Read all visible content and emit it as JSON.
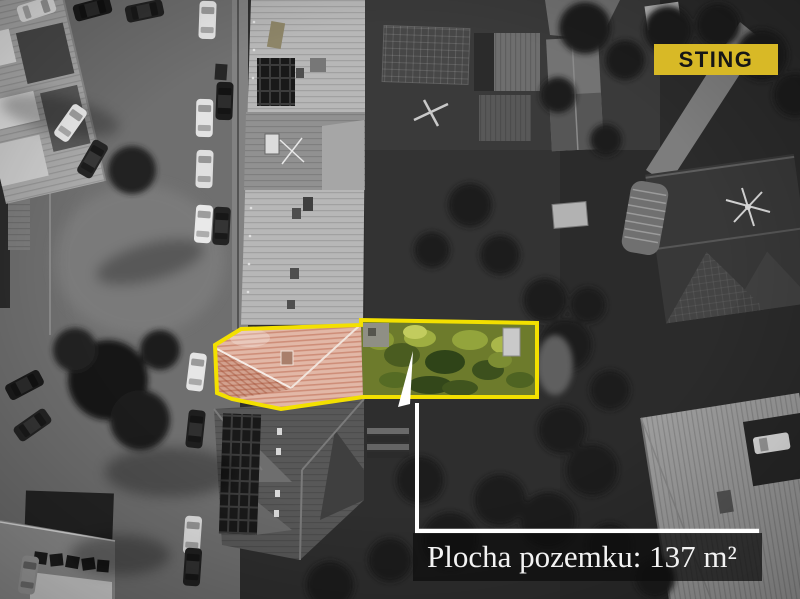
{
  "logo": {
    "text": "STING",
    "bg_color": "#d8b926",
    "text_color": "#161616"
  },
  "annotation": {
    "area_label": "Plocha pozemku: 137 m²",
    "line_color": "#ffffff",
    "box_bg": "rgba(13,13,13,0.72)",
    "text_color": "#f3f3f3"
  },
  "highlight": {
    "outline_color": "#f3e000",
    "outline_width": "4",
    "polygon_points": "215,345 241,329 361,325 361,320 537,323 537,397 363,397 281,409 232,399 217,393",
    "roof_points": "215,345 241,329 361,325 363,397 281,409 232,399 217,393",
    "garden_points": "361,325 361,320 537,323 537,397 363,397"
  },
  "scene_palette": {
    "street": "#6f6f6f",
    "garden_dark": "#2e2e2e",
    "building_roof": "#b7b7b7",
    "highlight_roof": "#e2b7a6",
    "highlight_garden": "#6d7b2c"
  }
}
